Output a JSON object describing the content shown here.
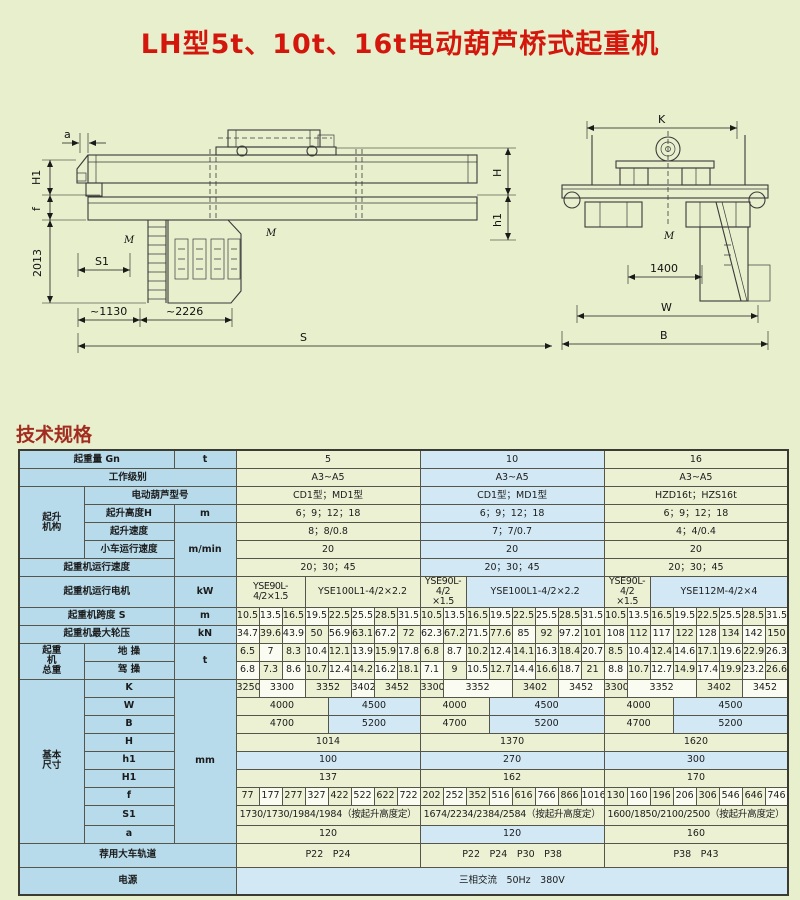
{
  "page": {
    "title": "LH型5t、10t、16t电动葫芦桥式起重机",
    "section_heading": "技术规格",
    "background_color": "#e8efcd",
    "title_color": "#d3170c",
    "heading_color": "#a12c1f"
  },
  "drawings": {
    "side": {
      "a": "a",
      "H1": "H1",
      "f": "f",
      "dim2013": "2013",
      "S1": "S1",
      "dim1130": "~1130",
      "dim2226": "~2226",
      "S": "S",
      "H": "H",
      "h1": "h1",
      "M1": "M",
      "M2": "M"
    },
    "end": {
      "K": "K",
      "dim1400": "1400",
      "W": "W",
      "B": "B",
      "M": "M"
    }
  },
  "table": {
    "rows": [
      {
        "cells": [
          {
            "t": "起重量 Gn",
            "cs": 2,
            "c": "lbl"
          },
          {
            "t": "t",
            "c": "lbl"
          },
          {
            "t": "5",
            "cs": 8,
            "c": "y"
          },
          {
            "t": "10",
            "cs": 8,
            "c": "b"
          },
          {
            "t": "16",
            "cs": 8,
            "c": "y"
          }
        ]
      },
      {
        "cells": [
          {
            "t": "工作级别",
            "cs": 3,
            "c": "lbl"
          },
          {
            "t": "A3~A5",
            "cs": 8,
            "c": "y"
          },
          {
            "t": "A3~A5",
            "cs": 8,
            "c": "b"
          },
          {
            "t": "A3~A5",
            "cs": 8,
            "c": "y"
          }
        ]
      },
      {
        "cells": [
          {
            "t": "起升\n机构",
            "rs": 4,
            "c": "lbl grp"
          },
          {
            "t": "电动葫芦型号",
            "cs": 2,
            "c": "lbl"
          },
          {
            "t": "CD1型；MD1型",
            "cs": 8,
            "c": "y"
          },
          {
            "t": "CD1型；MD1型",
            "cs": 8,
            "c": "b"
          },
          {
            "t": "HZD16t；HZS16t",
            "cs": 8,
            "c": "y"
          }
        ]
      },
      {
        "cells": [
          {
            "t": "起升高度H",
            "c": "lbl"
          },
          {
            "t": "m",
            "c": "lbl"
          },
          {
            "t": "6；9；12；18",
            "cs": 8,
            "c": "y"
          },
          {
            "t": "6；9；12；18",
            "cs": 8,
            "c": "b"
          },
          {
            "t": "6；9；12；18",
            "cs": 8,
            "c": "y"
          }
        ]
      },
      {
        "cells": [
          {
            "t": "起升速度",
            "c": "lbl"
          },
          {
            "t": "m/min",
            "rs": 3,
            "c": "lbl"
          },
          {
            "t": "8；8/0.8",
            "cs": 8,
            "c": "y"
          },
          {
            "t": "7；7/0.7",
            "cs": 8,
            "c": "b"
          },
          {
            "t": "4；4/0.4",
            "cs": 8,
            "c": "y"
          }
        ]
      },
      {
        "cells": [
          {
            "t": "小车运行速度",
            "c": "lbl"
          },
          {
            "t": "20",
            "cs": 8,
            "c": "y"
          },
          {
            "t": "20",
            "cs": 8,
            "c": "b"
          },
          {
            "t": "20",
            "cs": 8,
            "c": "y"
          }
        ]
      },
      {
        "cells": [
          {
            "t": "起重机运行速度",
            "cs": 2,
            "c": "lbl"
          },
          {
            "t": "20；30；45",
            "cs": 8,
            "c": "y"
          },
          {
            "t": "20；30；45",
            "cs": 8,
            "c": "b"
          },
          {
            "t": "20；30；45",
            "cs": 8,
            "c": "y"
          }
        ]
      },
      {
        "h": 22,
        "cells": [
          {
            "t": "起重机运行电机",
            "cs": 2,
            "c": "lbl"
          },
          {
            "t": "kW",
            "c": "lbl"
          },
          {
            "t": "YSE90L-4/2×1.5",
            "cs": 3,
            "c": "y sm1"
          },
          {
            "t": "YSE100L1-4/2×2.2",
            "cs": 5,
            "c": "y"
          },
          {
            "t": "YSE90L-4/2\n×1.5",
            "cs": 2,
            "c": "y sm"
          },
          {
            "t": "YSE100L1-4/2×2.2",
            "cs": 6,
            "c": "b"
          },
          {
            "t": "YSE90L-4/2\n×1.5",
            "cs": 2,
            "c": "y sm"
          },
          {
            "t": "YSE112M-4/2×4",
            "cs": 6,
            "c": "b"
          }
        ]
      },
      {
        "cells": [
          {
            "t": "起重机跨度 S",
            "cs": 2,
            "c": "lbl"
          },
          {
            "t": "m",
            "c": "lbl"
          },
          {
            "t": "10.5",
            "c": "y"
          },
          {
            "t": "13.5",
            "c": "w"
          },
          {
            "t": "16.5",
            "c": "y"
          },
          {
            "t": "19.5",
            "c": "w"
          },
          {
            "t": "22.5",
            "c": "y"
          },
          {
            "t": "25.5",
            "c": "w"
          },
          {
            "t": "28.5",
            "c": "y"
          },
          {
            "t": "31.5",
            "c": "w"
          },
          {
            "t": "10.5",
            "c": "y"
          },
          {
            "t": "13.5",
            "c": "w"
          },
          {
            "t": "16.5",
            "c": "y"
          },
          {
            "t": "19.5",
            "c": "w"
          },
          {
            "t": "22.5",
            "c": "y"
          },
          {
            "t": "25.5",
            "c": "w"
          },
          {
            "t": "28.5",
            "c": "y"
          },
          {
            "t": "31.5",
            "c": "w"
          },
          {
            "t": "10.5",
            "c": "y"
          },
          {
            "t": "13.5",
            "c": "w"
          },
          {
            "t": "16.5",
            "c": "y"
          },
          {
            "t": "19.5",
            "c": "w"
          },
          {
            "t": "22.5",
            "c": "y"
          },
          {
            "t": "25.5",
            "c": "w"
          },
          {
            "t": "28.5",
            "c": "y"
          },
          {
            "t": "31.5",
            "c": "w"
          }
        ]
      },
      {
        "cells": [
          {
            "t": "起重机最大轮压",
            "cs": 2,
            "c": "lbl"
          },
          {
            "t": "kN",
            "c": "lbl"
          },
          {
            "t": "34.7",
            "c": "w"
          },
          {
            "t": "39.6",
            "c": "y"
          },
          {
            "t": "43.9",
            "c": "w"
          },
          {
            "t": "50",
            "c": "y"
          },
          {
            "t": "56.9",
            "c": "w"
          },
          {
            "t": "63.1",
            "c": "y"
          },
          {
            "t": "67.2",
            "c": "w"
          },
          {
            "t": "72",
            "c": "y"
          },
          {
            "t": "62.3",
            "c": "w"
          },
          {
            "t": "67.2",
            "c": "y"
          },
          {
            "t": "71.5",
            "c": "w"
          },
          {
            "t": "77.6",
            "c": "y"
          },
          {
            "t": "85",
            "c": "w"
          },
          {
            "t": "92",
            "c": "y"
          },
          {
            "t": "97.2",
            "c": "w"
          },
          {
            "t": "101",
            "c": "y"
          },
          {
            "t": "108",
            "c": "w"
          },
          {
            "t": "112",
            "c": "y"
          },
          {
            "t": "117",
            "c": "w"
          },
          {
            "t": "122",
            "c": "y"
          },
          {
            "t": "128",
            "c": "w"
          },
          {
            "t": "134",
            "c": "y"
          },
          {
            "t": "142",
            "c": "w"
          },
          {
            "t": "150",
            "c": "y"
          }
        ]
      },
      {
        "cells": [
          {
            "t": "起重\n机\n总重",
            "rs": 2,
            "c": "lbl grp"
          },
          {
            "t": "地 操",
            "c": "lbl"
          },
          {
            "t": "t",
            "rs": 2,
            "c": "lbl"
          },
          {
            "t": "6.5",
            "c": "y"
          },
          {
            "t": "7",
            "c": "w"
          },
          {
            "t": "8.3",
            "c": "y"
          },
          {
            "t": "10.4",
            "c": "w"
          },
          {
            "t": "12.1",
            "c": "y"
          },
          {
            "t": "13.9",
            "c": "w"
          },
          {
            "t": "15.9",
            "c": "y"
          },
          {
            "t": "17.8",
            "c": "w"
          },
          {
            "t": "6.8",
            "c": "y"
          },
          {
            "t": "8.7",
            "c": "w"
          },
          {
            "t": "10.2",
            "c": "y"
          },
          {
            "t": "12.4",
            "c": "w"
          },
          {
            "t": "14.1",
            "c": "y"
          },
          {
            "t": "16.3",
            "c": "w"
          },
          {
            "t": "18.4",
            "c": "y"
          },
          {
            "t": "20.7",
            "c": "w"
          },
          {
            "t": "8.5",
            "c": "y"
          },
          {
            "t": "10.4",
            "c": "w"
          },
          {
            "t": "12.4",
            "c": "y"
          },
          {
            "t": "14.6",
            "c": "w"
          },
          {
            "t": "17.1",
            "c": "y"
          },
          {
            "t": "19.6",
            "c": "w"
          },
          {
            "t": "22.9",
            "c": "y"
          },
          {
            "t": "26.3",
            "c": "w"
          }
        ]
      },
      {
        "cells": [
          {
            "t": "驾 操",
            "c": "lbl"
          },
          {
            "t": "6.8",
            "c": "w"
          },
          {
            "t": "7.3",
            "c": "y"
          },
          {
            "t": "8.6",
            "c": "w"
          },
          {
            "t": "10.7",
            "c": "y"
          },
          {
            "t": "12.4",
            "c": "w"
          },
          {
            "t": "14.2",
            "c": "y"
          },
          {
            "t": "16.2",
            "c": "w"
          },
          {
            "t": "18.1",
            "c": "y"
          },
          {
            "t": "7.1",
            "c": "w"
          },
          {
            "t": "9",
            "c": "y"
          },
          {
            "t": "10.5",
            "c": "w"
          },
          {
            "t": "12.7",
            "c": "y"
          },
          {
            "t": "14.4",
            "c": "w"
          },
          {
            "t": "16.6",
            "c": "y"
          },
          {
            "t": "18.7",
            "c": "w"
          },
          {
            "t": "21",
            "c": "y"
          },
          {
            "t": "8.8",
            "c": "w"
          },
          {
            "t": "10.7",
            "c": "y"
          },
          {
            "t": "12.7",
            "c": "w"
          },
          {
            "t": "14.9",
            "c": "y"
          },
          {
            "t": "17.4",
            "c": "w"
          },
          {
            "t": "19.9",
            "c": "y"
          },
          {
            "t": "23.2",
            "c": "w"
          },
          {
            "t": "26.6",
            "c": "y"
          }
        ]
      },
      {
        "cells": [
          {
            "t": "基本\n尺寸",
            "rs": 9,
            "c": "lbl grp"
          },
          {
            "t": "K",
            "c": "lbl"
          },
          {
            "t": "mm",
            "rs": 9,
            "c": "lbl"
          },
          {
            "t": "3250",
            "c": "y"
          },
          {
            "t": "3300",
            "cs": 2,
            "c": "w"
          },
          {
            "t": "3352",
            "cs": 2,
            "c": "y"
          },
          {
            "t": "3402",
            "c": "w"
          },
          {
            "t": "3452",
            "cs": 2,
            "c": "y"
          },
          {
            "t": "3300",
            "c": "y"
          },
          {
            "t": "3352",
            "cs": 3,
            "c": "w"
          },
          {
            "t": "3402",
            "cs": 2,
            "c": "y"
          },
          {
            "t": "3452",
            "cs": 2,
            "c": "w"
          },
          {
            "t": "3300",
            "c": "y"
          },
          {
            "t": "3352",
            "cs": 3,
            "c": "w"
          },
          {
            "t": "3402",
            "cs": 2,
            "c": "y"
          },
          {
            "t": "3452",
            "cs": 2,
            "c": "w"
          }
        ]
      },
      {
        "cells": [
          {
            "t": "W",
            "c": "lbl"
          },
          {
            "t": "4000",
            "cs": 4,
            "c": "y"
          },
          {
            "t": "4500",
            "cs": 4,
            "c": "b"
          },
          {
            "t": "4000",
            "cs": 3,
            "c": "y"
          },
          {
            "t": "4500",
            "cs": 5,
            "c": "b"
          },
          {
            "t": "4000",
            "cs": 3,
            "c": "y"
          },
          {
            "t": "4500",
            "cs": 5,
            "c": "b"
          }
        ]
      },
      {
        "cells": [
          {
            "t": "B",
            "c": "lbl"
          },
          {
            "t": "4700",
            "cs": 4,
            "c": "y"
          },
          {
            "t": "5200",
            "cs": 4,
            "c": "b"
          },
          {
            "t": "4700",
            "cs": 3,
            "c": "y"
          },
          {
            "t": "5200",
            "cs": 5,
            "c": "b"
          },
          {
            "t": "4700",
            "cs": 3,
            "c": "y"
          },
          {
            "t": "5200",
            "cs": 5,
            "c": "b"
          }
        ]
      },
      {
        "cells": [
          {
            "t": "H",
            "c": "lbl"
          },
          {
            "t": "1014",
            "cs": 8,
            "c": "y"
          },
          {
            "t": "1370",
            "cs": 8,
            "c": "y"
          },
          {
            "t": "1620",
            "cs": 8,
            "c": "y"
          }
        ]
      },
      {
        "cells": [
          {
            "t": "h1",
            "c": "lbl"
          },
          {
            "t": "100",
            "cs": 8,
            "c": "b"
          },
          {
            "t": "270",
            "cs": 8,
            "c": "b"
          },
          {
            "t": "300",
            "cs": 8,
            "c": "b"
          }
        ]
      },
      {
        "cells": [
          {
            "t": "H1",
            "c": "lbl"
          },
          {
            "t": "137",
            "cs": 8,
            "c": "y"
          },
          {
            "t": "162",
            "cs": 8,
            "c": "y"
          },
          {
            "t": "170",
            "cs": 8,
            "c": "y"
          }
        ]
      },
      {
        "cells": [
          {
            "t": "f",
            "c": "lbl"
          },
          {
            "t": "77",
            "c": "y"
          },
          {
            "t": "177",
            "c": "w"
          },
          {
            "t": "277",
            "c": "y"
          },
          {
            "t": "327",
            "c": "w"
          },
          {
            "t": "422",
            "c": "y"
          },
          {
            "t": "522",
            "c": "w"
          },
          {
            "t": "622",
            "c": "y"
          },
          {
            "t": "722",
            "c": "w"
          },
          {
            "t": "202",
            "c": "y"
          },
          {
            "t": "252",
            "c": "w"
          },
          {
            "t": "352",
            "c": "y"
          },
          {
            "t": "516",
            "c": "w"
          },
          {
            "t": "616",
            "c": "y"
          },
          {
            "t": "766",
            "c": "w"
          },
          {
            "t": "866",
            "c": "y"
          },
          {
            "t": "1016",
            "c": "w"
          },
          {
            "t": "130",
            "c": "y"
          },
          {
            "t": "160",
            "c": "w"
          },
          {
            "t": "196",
            "c": "y"
          },
          {
            "t": "206",
            "c": "w"
          },
          {
            "t": "306",
            "c": "y"
          },
          {
            "t": "546",
            "c": "w"
          },
          {
            "t": "646",
            "c": "y"
          },
          {
            "t": "746",
            "c": "w"
          }
        ]
      },
      {
        "h": 20,
        "cells": [
          {
            "t": "S1",
            "c": "lbl"
          },
          {
            "t": "1730/1730/1984/1984（按起升高度定）",
            "cs": 8,
            "c": "y tt"
          },
          {
            "t": "1674/2234/2384/2584（按起升高度定）",
            "cs": 8,
            "c": "y tt"
          },
          {
            "t": "1600/1850/2100/2500（按起升高度定）",
            "cs": 8,
            "c": "y tt"
          }
        ]
      },
      {
        "cells": [
          {
            "t": "a",
            "c": "lbl"
          },
          {
            "t": "120",
            "cs": 8,
            "c": "y"
          },
          {
            "t": "120",
            "cs": 8,
            "c": "b"
          },
          {
            "t": "160",
            "cs": 8,
            "c": "y"
          }
        ]
      },
      {
        "h": 24,
        "cells": [
          {
            "t": "荐用大车轨道",
            "cs": 3,
            "c": "lbl"
          },
          {
            "t": "P22　P24",
            "cs": 8,
            "c": "y"
          },
          {
            "t": "P22　P24　P30　P38",
            "cs": 8,
            "c": "y"
          },
          {
            "t": "P38　P43",
            "cs": 8,
            "c": "y"
          }
        ]
      },
      {
        "h": 28,
        "cells": [
          {
            "t": "电源",
            "cs": 3,
            "c": "lbl"
          },
          {
            "t": "三相交流　50Hz　380V",
            "cs": 24,
            "c": "b"
          }
        ]
      }
    ]
  }
}
